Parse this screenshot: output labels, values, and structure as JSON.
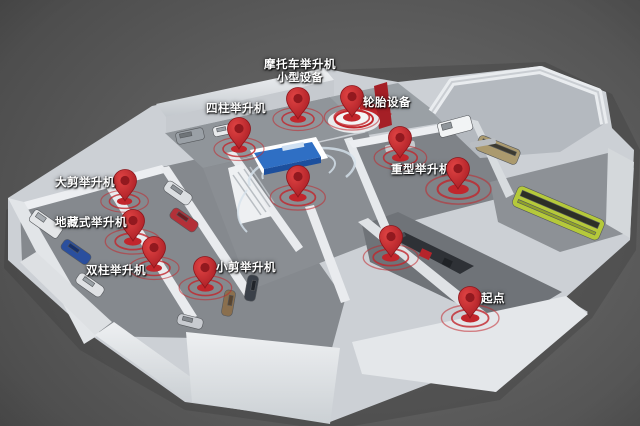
{
  "scene": {
    "colors": {
      "pin_red": "#c2262c",
      "pin_red_dark": "#92191f",
      "label_white": "#ffffff",
      "accent_red_wall": "#c1272d",
      "bus_green": "#b5c93a",
      "display_blue": "#2f6fc4",
      "background": "#5c5c5c"
    },
    "pins": [
      {
        "id": "motorcycle-lift-small-equipment",
        "label": "摩托车举升机",
        "label2": "小型设备",
        "x": 298,
        "y": 119,
        "lx": 300,
        "ly": 59,
        "anchor": "center",
        "ripple": 1.0
      },
      {
        "id": "tire-equipment",
        "label": "轮胎设备",
        "label2": "",
        "x": 352,
        "y": 117,
        "lx": 363,
        "ly": 97,
        "anchor": "left",
        "ripple": 1.1
      },
      {
        "id": "four-post-lift",
        "label": "四柱举升机",
        "label2": "",
        "x": 239,
        "y": 149,
        "lx": 206,
        "ly": 103,
        "anchor": "left",
        "ripple": 1.0
      },
      {
        "id": "large-scissor-lift",
        "label": "大剪举升机",
        "label2": "",
        "x": 125,
        "y": 201,
        "lx": 55,
        "ly": 177,
        "anchor": "left",
        "ripple": 0.95
      },
      {
        "id": "in-ground-lift",
        "label": "地藏式举升机",
        "label2": "",
        "x": 133,
        "y": 241,
        "lx": 55,
        "ly": 217,
        "anchor": "left",
        "ripple": 1.1
      },
      {
        "id": "two-post-lift",
        "label": "双柱举升机",
        "label2": "",
        "x": 154,
        "y": 268,
        "lx": 86,
        "ly": 265,
        "anchor": "left",
        "ripple": 1.0
      },
      {
        "id": "small-scissor-lift",
        "label": "小剪举升机",
        "label2": "",
        "x": 205,
        "y": 288,
        "lx": 216,
        "ly": 262,
        "anchor": "left",
        "ripple": 1.05
      },
      {
        "id": "center-corridor",
        "label": "",
        "label2": "",
        "x": 298,
        "y": 197,
        "lx": 0,
        "ly": 0,
        "anchor": "left",
        "ripple": 1.1
      },
      {
        "id": "heavy-duty-lift-a",
        "label": "重型举升机",
        "label2": "",
        "x": 400,
        "y": 158,
        "lx": 391,
        "ly": 164,
        "anchor": "left",
        "ripple": 1.05
      },
      {
        "id": "heavy-duty-lift-b",
        "label": "",
        "label2": "",
        "x": 458,
        "y": 189,
        "lx": 0,
        "ly": 0,
        "anchor": "left",
        "ripple": 1.3
      },
      {
        "id": "display-corridor",
        "label": "",
        "label2": "",
        "x": 391,
        "y": 257,
        "lx": 0,
        "ly": 0,
        "anchor": "left",
        "ripple": 1.1
      },
      {
        "id": "start-point",
        "label": "起点",
        "label2": "",
        "x": 470,
        "y": 318,
        "lx": 481,
        "ly": 293,
        "anchor": "left",
        "ripple": 1.15
      }
    ]
  }
}
